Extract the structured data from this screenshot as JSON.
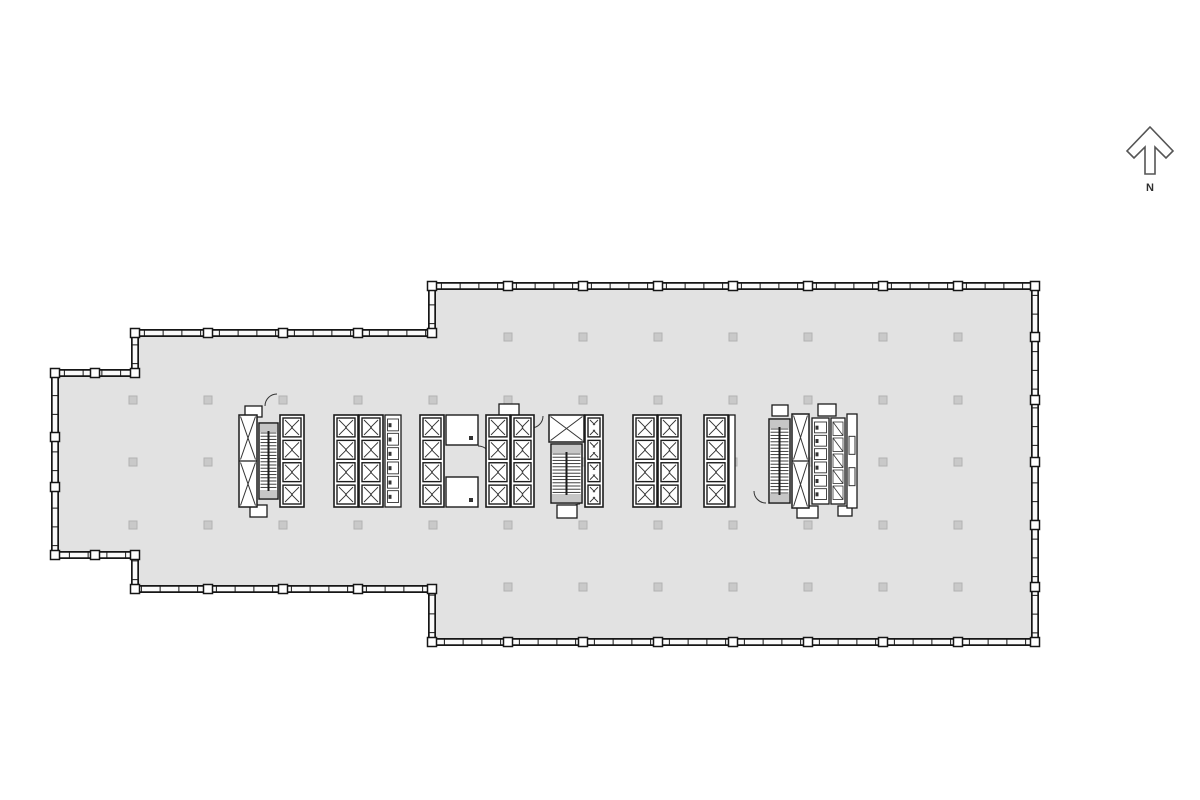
{
  "compass": {
    "label": "N"
  },
  "canvas": {
    "width": 1200,
    "height": 800
  },
  "colors": {
    "floor": "#e2e2e2",
    "wall": "#161616",
    "wall_fill": "#fafafa",
    "marker": "#c9c9c9",
    "marker_border": "#b3b3b3",
    "line": "#1c1c1c",
    "thin": "#333333",
    "tread": "#2a2a2a",
    "landing": "#c6c6c6",
    "white": "#ffffff",
    "compass_stroke": "#555555"
  },
  "floor_plan": {
    "outline": [
      [
        135,
        333
      ],
      [
        432,
        333
      ],
      [
        432,
        286
      ],
      [
        1035,
        286
      ],
      [
        1035,
        642
      ],
      [
        432,
        642
      ],
      [
        432,
        589
      ],
      [
        135,
        589
      ],
      [
        135,
        555
      ],
      [
        55,
        555
      ],
      [
        55,
        373
      ],
      [
        135,
        373
      ]
    ],
    "tick_spacing": 18.75,
    "wall_band": 8,
    "grid_markers": {
      "size": 8,
      "cols_main": [
        133,
        208,
        283,
        358,
        433,
        508,
        583,
        658,
        733,
        808,
        883,
        958
      ],
      "rows_main": [
        400,
        462,
        525
      ],
      "cols_wide": [
        508,
        583,
        658,
        733,
        808,
        883,
        958
      ],
      "rows_wide": [
        337,
        587
      ]
    },
    "wall_squares": [
      [
        135,
        333
      ],
      [
        432,
        333
      ],
      [
        432,
        286
      ],
      [
        1035,
        286
      ],
      [
        1035,
        642
      ],
      [
        432,
        642
      ],
      [
        432,
        589
      ],
      [
        135,
        589
      ],
      [
        135,
        555
      ],
      [
        55,
        555
      ],
      [
        55,
        373
      ],
      [
        135,
        373
      ],
      [
        508,
        286
      ],
      [
        583,
        286
      ],
      [
        658,
        286
      ],
      [
        733,
        286
      ],
      [
        808,
        286
      ],
      [
        883,
        286
      ],
      [
        958,
        286
      ],
      [
        508,
        642
      ],
      [
        583,
        642
      ],
      [
        658,
        642
      ],
      [
        733,
        642
      ],
      [
        808,
        642
      ],
      [
        883,
        642
      ],
      [
        958,
        642
      ],
      [
        1035,
        337
      ],
      [
        1035,
        400
      ],
      [
        1035,
        462
      ],
      [
        1035,
        525
      ],
      [
        1035,
        587
      ],
      [
        208,
        333
      ],
      [
        283,
        333
      ],
      [
        358,
        333
      ],
      [
        208,
        589
      ],
      [
        283,
        589
      ],
      [
        358,
        589
      ],
      [
        55,
        437
      ],
      [
        55,
        487
      ],
      [
        95,
        373
      ],
      [
        95,
        555
      ]
    ],
    "door_arcs": [
      {
        "x": 265,
        "y": 406,
        "r": 12,
        "dx": 12,
        "dy": -12
      },
      {
        "x": 478,
        "y": 446,
        "r": 13,
        "dx": 13,
        "dy": 13
      },
      {
        "x": 500,
        "y": 414,
        "r": 9,
        "dx": 9,
        "dy": -9
      },
      {
        "x": 519,
        "y": 414,
        "r": 9,
        "dx": -9,
        "dy": -9
      },
      {
        "x": 543,
        "y": 416,
        "r": 12,
        "dx": -12,
        "dy": 12
      },
      {
        "x": 568,
        "y": 516,
        "r": 12,
        "dx": 12,
        "dy": -12
      },
      {
        "x": 766,
        "y": 503,
        "r": 12,
        "dx": -12,
        "dy": -12
      }
    ],
    "core_blocks": [
      {
        "name": "stair-elevator-core-west",
        "parts": [
          {
            "t": "bump",
            "x": 245,
            "y": 406,
            "w": 17,
            "h": 11
          },
          {
            "t": "bump",
            "x": 250,
            "y": 505,
            "w": 17,
            "h": 12
          },
          {
            "t": "xshaft",
            "x": 239,
            "y": 415,
            "w": 18,
            "h": 92,
            "splits": 2
          },
          {
            "t": "stair",
            "x": 259,
            "y": 423,
            "w": 19,
            "h": 76
          },
          {
            "t": "elev",
            "x": 280,
            "y": 415,
            "w": 24,
            "h": 92,
            "cabs": 4
          }
        ]
      },
      {
        "name": "elevator-bank-restroom-core",
        "parts": [
          {
            "t": "elev",
            "x": 334,
            "y": 415,
            "w": 24,
            "h": 92,
            "cabs": 4
          },
          {
            "t": "elev",
            "x": 359,
            "y": 415,
            "w": 24,
            "h": 92,
            "cabs": 4
          },
          {
            "t": "fixt",
            "x": 385,
            "y": 415,
            "w": 16,
            "h": 92,
            "n": 6
          },
          {
            "t": "elev",
            "x": 420,
            "y": 415,
            "w": 24,
            "h": 92,
            "cabs": 4
          },
          {
            "t": "room",
            "x": 446,
            "y": 415,
            "w": 32,
            "h": 30,
            "dot": true
          },
          {
            "t": "room",
            "x": 446,
            "y": 477,
            "w": 32,
            "h": 30,
            "dot": true
          }
        ]
      },
      {
        "name": "elevator-bank-center-west",
        "parts": [
          {
            "t": "bump",
            "x": 499,
            "y": 404,
            "w": 20,
            "h": 12
          },
          {
            "t": "elev",
            "x": 486,
            "y": 415,
            "w": 24,
            "h": 92,
            "cabs": 4
          },
          {
            "t": "elev",
            "x": 511,
            "y": 415,
            "w": 23,
            "h": 92,
            "cabs": 4
          }
        ]
      },
      {
        "name": "stair-machine-core-center",
        "parts": [
          {
            "t": "bump",
            "x": 557,
            "y": 505,
            "w": 20,
            "h": 13
          },
          {
            "t": "xshaft",
            "x": 549,
            "y": 415,
            "w": 35,
            "h": 27,
            "splits": 1
          },
          {
            "t": "stair",
            "x": 551,
            "y": 444,
            "w": 31,
            "h": 59
          },
          {
            "t": "elev",
            "x": 585,
            "y": 415,
            "w": 18,
            "h": 92,
            "cabs": 4
          }
        ]
      },
      {
        "name": "elevator-bank-center-east",
        "parts": [
          {
            "t": "elev",
            "x": 633,
            "y": 415,
            "w": 24,
            "h": 92,
            "cabs": 4
          },
          {
            "t": "elev",
            "x": 658,
            "y": 415,
            "w": 23,
            "h": 92,
            "cabs": 4
          }
        ]
      },
      {
        "name": "elevator-bank-single",
        "parts": [
          {
            "t": "elev",
            "x": 704,
            "y": 415,
            "w": 24,
            "h": 92,
            "cabs": 4
          },
          {
            "t": "strip",
            "x": 729,
            "y": 415,
            "w": 6,
            "h": 92,
            "marks": 0
          }
        ]
      },
      {
        "name": "stair-restroom-core-east",
        "parts": [
          {
            "t": "bump",
            "x": 772,
            "y": 405,
            "w": 16,
            "h": 11
          },
          {
            "t": "bump",
            "x": 818,
            "y": 404,
            "w": 18,
            "h": 12
          },
          {
            "t": "bump",
            "x": 797,
            "y": 506,
            "w": 21,
            "h": 12
          },
          {
            "t": "bump",
            "x": 838,
            "y": 506,
            "w": 14,
            "h": 10
          },
          {
            "t": "stair",
            "x": 769,
            "y": 419,
            "w": 21,
            "h": 84
          },
          {
            "t": "xshaft",
            "x": 792,
            "y": 414,
            "w": 17,
            "h": 94,
            "splits": 2
          },
          {
            "t": "fixt",
            "x": 812,
            "y": 418,
            "w": 17,
            "h": 86,
            "n": 6
          },
          {
            "t": "stalls",
            "x": 831,
            "y": 418,
            "w": 14,
            "h": 86,
            "n": 5
          },
          {
            "t": "strip",
            "x": 847,
            "y": 414,
            "w": 10,
            "h": 94,
            "marks": 2
          }
        ]
      }
    ]
  }
}
